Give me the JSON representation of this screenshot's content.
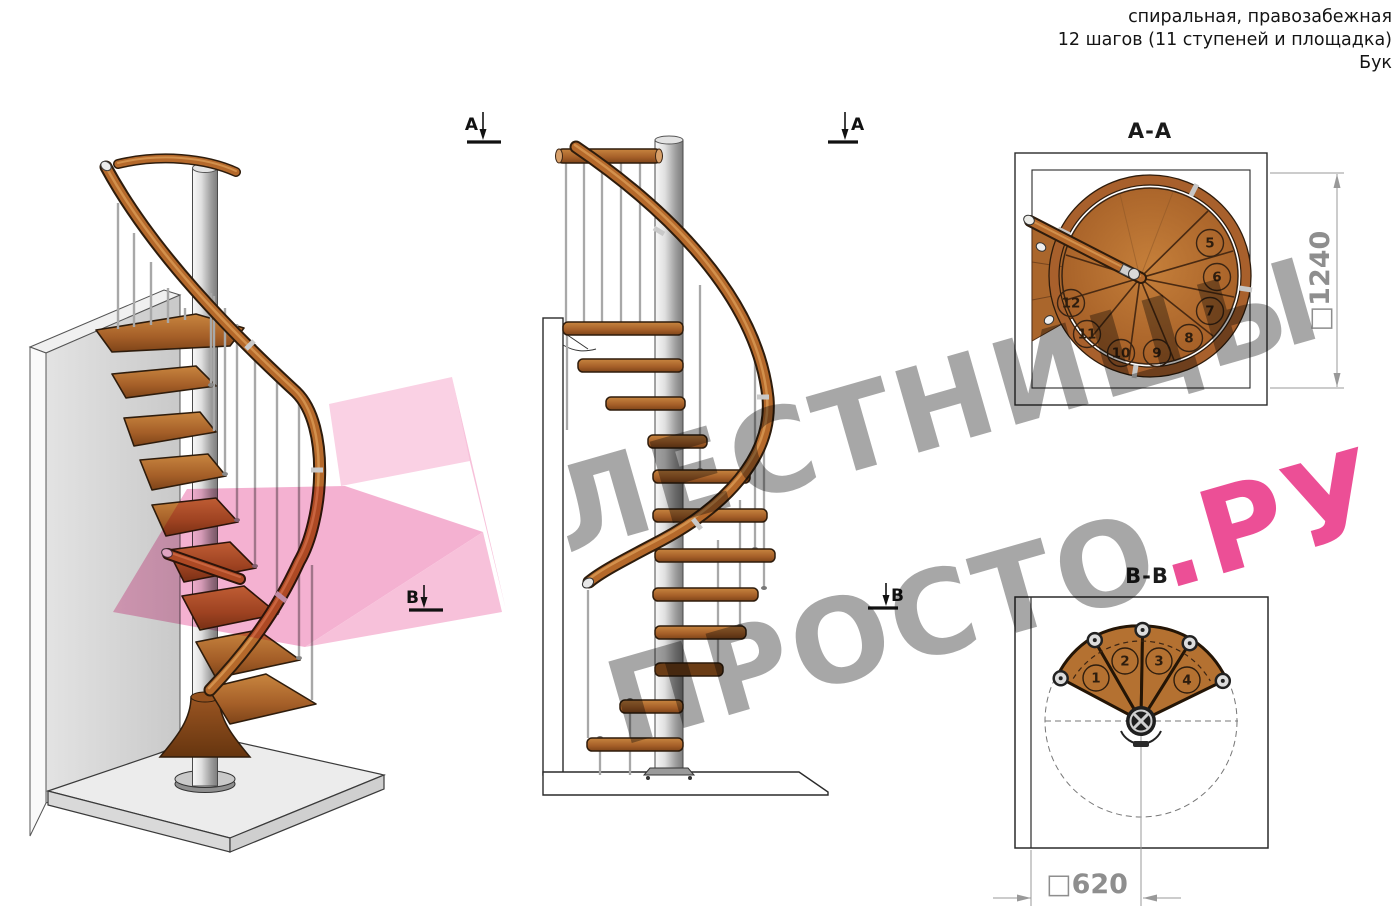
{
  "header": {
    "line1": "спиральная, правозабежная",
    "line2": "12 шагов (11 ступеней и площадка)",
    "line3": "Бук"
  },
  "watermark": {
    "line1": "ЛЕСТНИЦЫ",
    "line2_gray": "ПРОСТО",
    "line2_pink": ".РУ"
  },
  "markers": {
    "a": "A",
    "b": "B"
  },
  "views": {
    "aa": {
      "label": "A-A",
      "dimension_label": "□1240",
      "step_numbers": [
        "5",
        "6",
        "7",
        "8",
        "9",
        "10",
        "11",
        "12"
      ]
    },
    "bb": {
      "label": "B-B",
      "dimension_label": "□620",
      "step_numbers": [
        "1",
        "2",
        "3",
        "4"
      ]
    }
  },
  "colors": {
    "wood_mid": "#b5692b",
    "wood_dark": "#7e4419",
    "pink_accent": "#ec4f96",
    "dimension_gray": "#8e8e8e",
    "pole_gray": "#c9c9c9"
  }
}
